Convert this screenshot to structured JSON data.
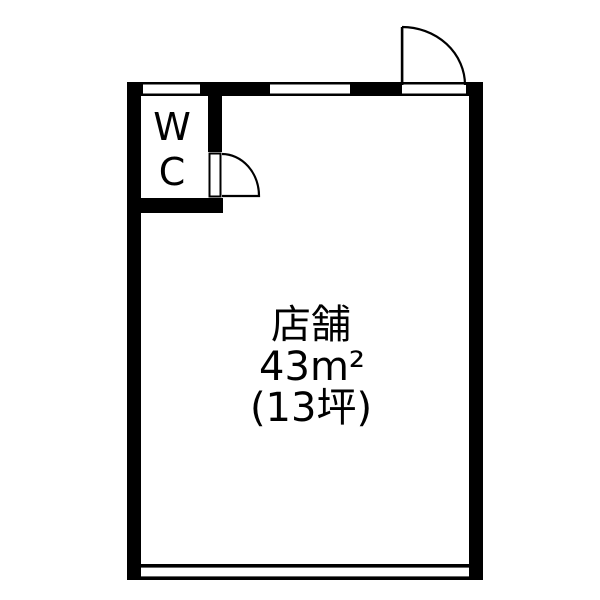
{
  "page": {
    "background_color": "#ffffff"
  },
  "floor_plan": {
    "wall_color": "#000000",
    "floor_color": "#ffffff",
    "line_color": "#000000",
    "shop_room": {
      "name": "店舗",
      "area_m2": "43m²",
      "area_tsubo": "(13坪)"
    },
    "wc_room": {
      "label": "WC",
      "label_line1": "W",
      "label_line2": "C"
    }
  }
}
